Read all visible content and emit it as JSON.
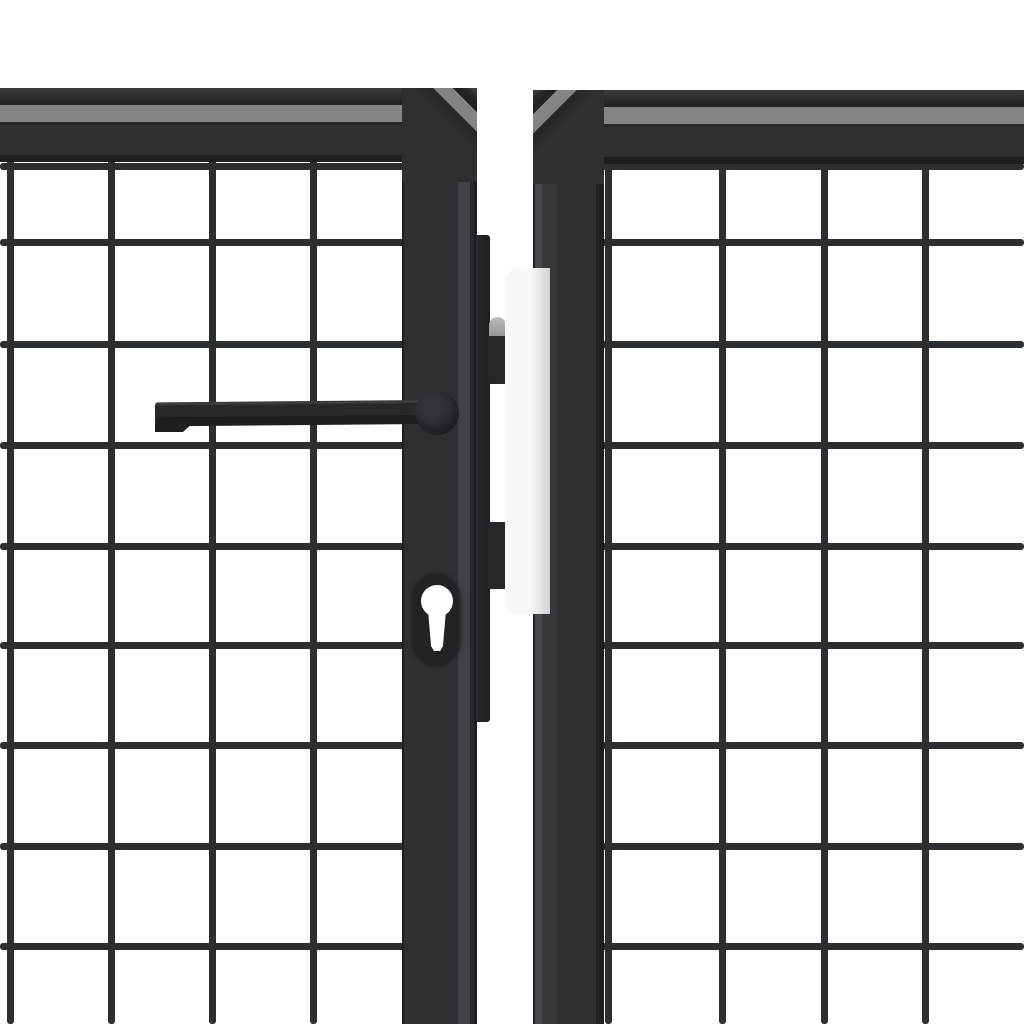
{
  "meta": {
    "description": "Close-up product photo of an anthracite grey steel mesh garden gate: left leaf lock stile with lever handle and euro-cylinder keyhole, lock box with latch and dead bolts, light stainless strike plate, and the hinge stile of the right leaf, on a plain white background."
  },
  "scene": {
    "background_color": "#ffffff",
    "colors": {
      "frame_face": "#2d3033",
      "frame_edge_dark": "#1d2022",
      "frame_top_light": "#828487",
      "frame_separator": "#26292b",
      "chamfer_light": "#3e4145",
      "mesh_wire": "#2c2f31",
      "latch_bolt": "#26282b",
      "latch_cap_light": "#bbbdbe",
      "strike_plate_light": "#f6f7f7",
      "strike_plate_mid": "#e9eaea",
      "strike_plate_dark": "#cfd1d2",
      "keyhole_white": "#ffffff",
      "escutcheon": "#212427",
      "background": "#ffffff"
    },
    "mesh": {
      "wire_thickness_px": 7,
      "horizontal_wires_y": [
        166,
        242,
        344,
        445,
        546,
        645,
        745,
        846,
        946
      ],
      "left_vertical_wires_x": [
        10,
        111,
        212,
        313
      ],
      "right_vertical_wires_x": [
        608,
        722,
        824,
        925
      ],
      "left_horizontal_span": [
        0,
        410
      ],
      "right_horizontal_span": [
        596,
        1024
      ],
      "vertical_span": [
        150,
        1024
      ]
    }
  }
}
